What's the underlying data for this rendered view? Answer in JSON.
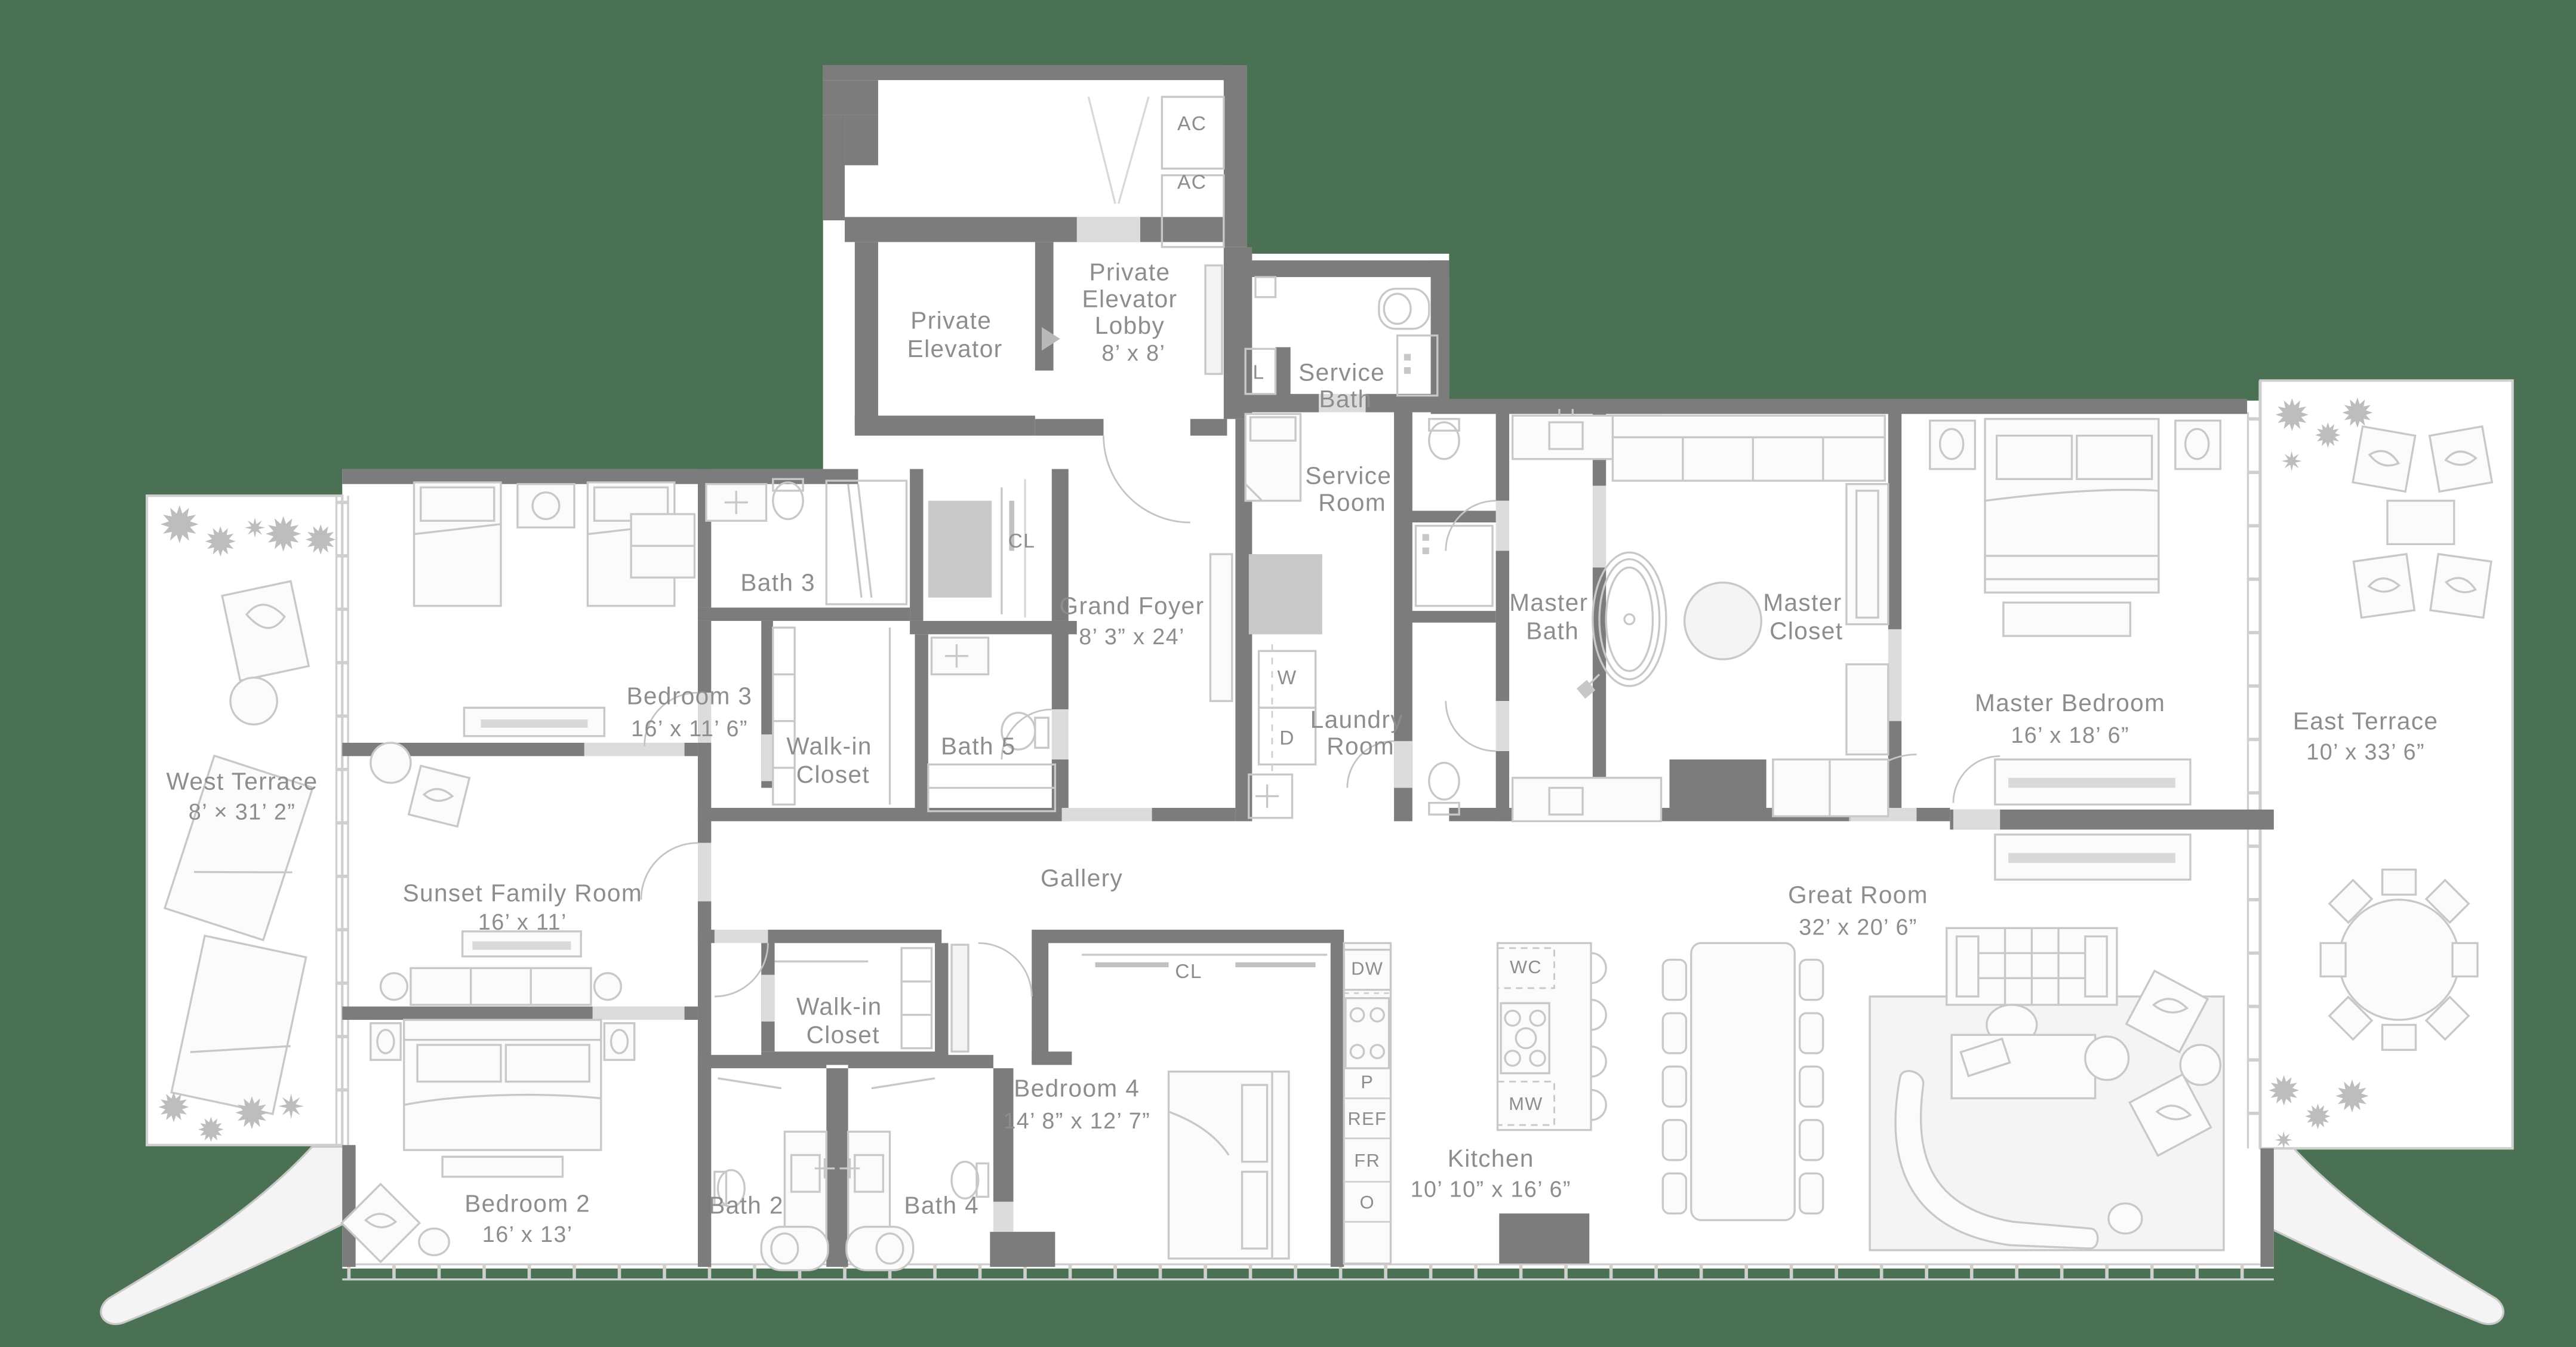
{
  "plan_title": "Residence Floor Plan",
  "colors": {
    "background": "#4a7153",
    "wall": "#7c7c7c",
    "floor": "#ffffff",
    "furniture_line": "#c8c8c8",
    "label_text": "#8d8d8d",
    "shaft_fill": "#c9c9c9"
  },
  "rooms": {
    "private_elevator": {
      "lines": [
        "Private",
        "Elevator"
      ]
    },
    "private_elevator_lobby": {
      "lines": [
        "Private",
        "Elevator",
        "Lobby"
      ],
      "dims": "8’ x 8’"
    },
    "service_bath": {
      "lines": [
        "Service",
        "Bath"
      ]
    },
    "service_room": {
      "lines": [
        "Service",
        "Room"
      ]
    },
    "laundry_room": {
      "lines": [
        "Laundry",
        "Room"
      ]
    },
    "master_bath": {
      "lines": [
        "Master",
        "Bath"
      ]
    },
    "master_closet": {
      "lines": [
        "Master",
        "Closet"
      ]
    },
    "master_bedroom": {
      "name": "Master Bedroom",
      "dims": "16’ x 18’ 6”"
    },
    "east_terrace": {
      "name": "East Terrace",
      "dims": "10’ x 33’ 6”"
    },
    "west_terrace": {
      "name": "West Terrace",
      "dims": "8’ × 31’ 2”"
    },
    "bedroom_3": {
      "name": "Bedroom 3",
      "dims": "16’ x 11’ 6”"
    },
    "bath_3": {
      "name": "Bath 3"
    },
    "walk_in_closet_upper": {
      "lines": [
        "Walk-in",
        "Closet"
      ]
    },
    "bath_5": {
      "name": "Bath 5"
    },
    "cl_upper": {
      "name": "CL"
    },
    "grand_foyer": {
      "name": "Grand Foyer",
      "dims": "8’ 3” x 24’"
    },
    "gallery": {
      "name": "Gallery"
    },
    "sunset_family_room": {
      "name": "Sunset Family Room",
      "dims": "16’ x 11’"
    },
    "bedroom_2": {
      "name": "Bedroom 2",
      "dims": "16’ x 13’"
    },
    "bath_2": {
      "name": "Bath 2"
    },
    "bath_4": {
      "name": "Bath 4"
    },
    "walk_in_closet_lower": {
      "lines": [
        "Walk-in",
        "Closet"
      ]
    },
    "cl_lower": {
      "name": "CL"
    },
    "bedroom_4": {
      "name": "Bedroom 4",
      "dims": "14’ 8” x 12’ 7”"
    },
    "kitchen": {
      "name": "Kitchen",
      "dims": "10’ 10” x 16’ 6”"
    },
    "great_room": {
      "name": "Great Room",
      "dims": "32’ x 20’ 6”"
    }
  },
  "appliances": {
    "ac1": "AC",
    "ac2": "AC",
    "linen": "L",
    "washer": "W",
    "dryer": "D",
    "dishwasher": "DW",
    "wine_cooler": "WC",
    "microwave": "MW",
    "pantry": "P",
    "refrigerator": "REF",
    "freezer": "FR",
    "oven": "O"
  }
}
